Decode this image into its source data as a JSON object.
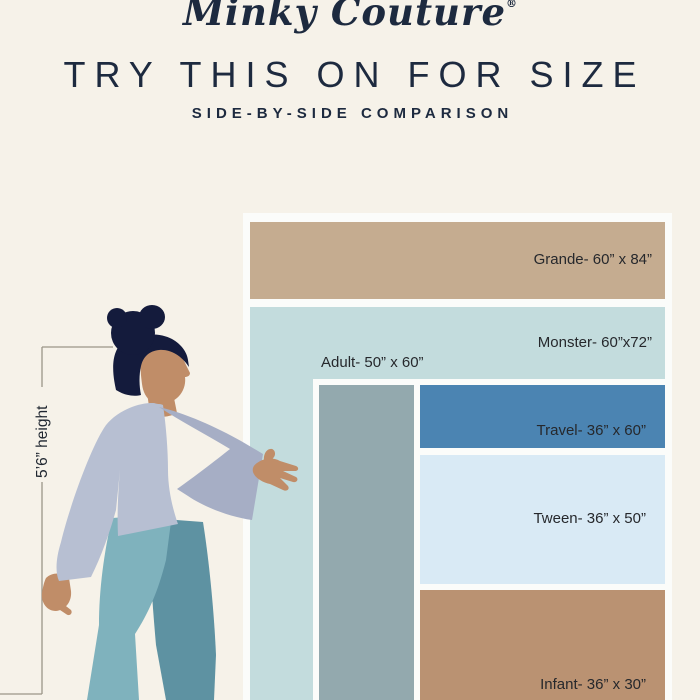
{
  "page": {
    "background": "#f6f2e9",
    "accent_navy": "#1d2a3f",
    "frame_white": "#fbfcfa"
  },
  "header": {
    "logo_text": "Minky Couture",
    "logo_registered": "®",
    "title": "TRY THIS ON FOR SIZE",
    "subtitle": "SIDE-BY-SIDE COMPARISON"
  },
  "person": {
    "height_label": "5’6” height"
  },
  "sizes": {
    "grande": {
      "name": "Grande",
      "label": "Grande- 60” x 84”",
      "color": "#c5ac90"
    },
    "monster": {
      "name": "Monster",
      "label": "Monster- 60”x72”",
      "color": "#c3dcdd"
    },
    "adult": {
      "name": "Adult",
      "label": "Adult- 50” x 60”",
      "color": "#93a9ae"
    },
    "travel": {
      "name": "Travel",
      "label": "Travel- 36” x 60”",
      "color": "#4b84b2"
    },
    "tween": {
      "name": "Tween",
      "label": "Tween- 36” x 50”",
      "color": "#d9eaf5"
    },
    "infant": {
      "name": "Infant",
      "label": "Infant- 36” x 30”",
      "color": "#ba9272"
    }
  },
  "illustration": {
    "hair_color": "#141b3c",
    "skin_color": "#c08d68",
    "sweater_color": "#b7bfd2",
    "sleeve_color": "#a6aec5",
    "front_leg_color": "#7fb2bd",
    "back_leg_color": "#5e92a2",
    "bracket_color": "#9b9588"
  }
}
